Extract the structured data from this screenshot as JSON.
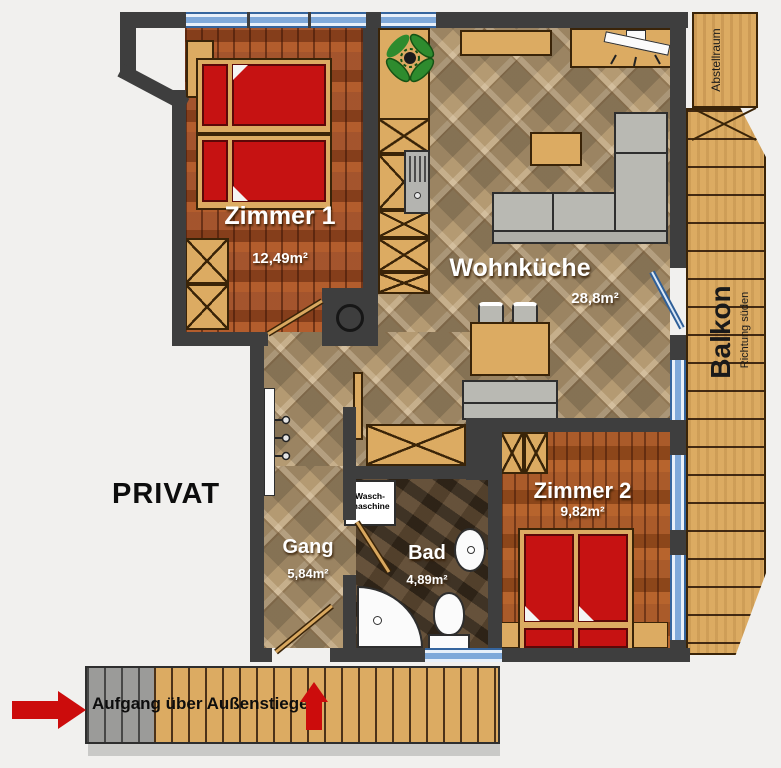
{
  "rooms": {
    "zimmer1": {
      "name": "Zimmer 1",
      "area": "12,49m²"
    },
    "wohnkueche": {
      "name": "Wohnküche",
      "area": "28,8m²"
    },
    "zimmer2": {
      "name": "Zimmer 2",
      "area": "9,82m²"
    },
    "gang": {
      "name": "Gang",
      "area": "5,84m²"
    },
    "bad": {
      "name": "Bad",
      "area": "4,89m²"
    },
    "balkon": {
      "name": "Balkon",
      "direction": "Richtung süden"
    },
    "abstellraum": {
      "name": "Abstellraum"
    }
  },
  "labels": {
    "privat": "PRIVAT",
    "stairs": "Aufgang über Außenstiege",
    "washer": {
      "line1": "Wasch-",
      "line2": "maschine"
    }
  },
  "colors": {
    "wall": "#3e3e3e",
    "bed_red": "#c61212",
    "arrow_red": "#cc0c0c",
    "window_blue": "#7fa9da",
    "wood_tan": "#dcab62",
    "tile_tan": "#b49a72",
    "plank_brown": "#9e4a20",
    "bath_brown": "#4e3c28"
  }
}
